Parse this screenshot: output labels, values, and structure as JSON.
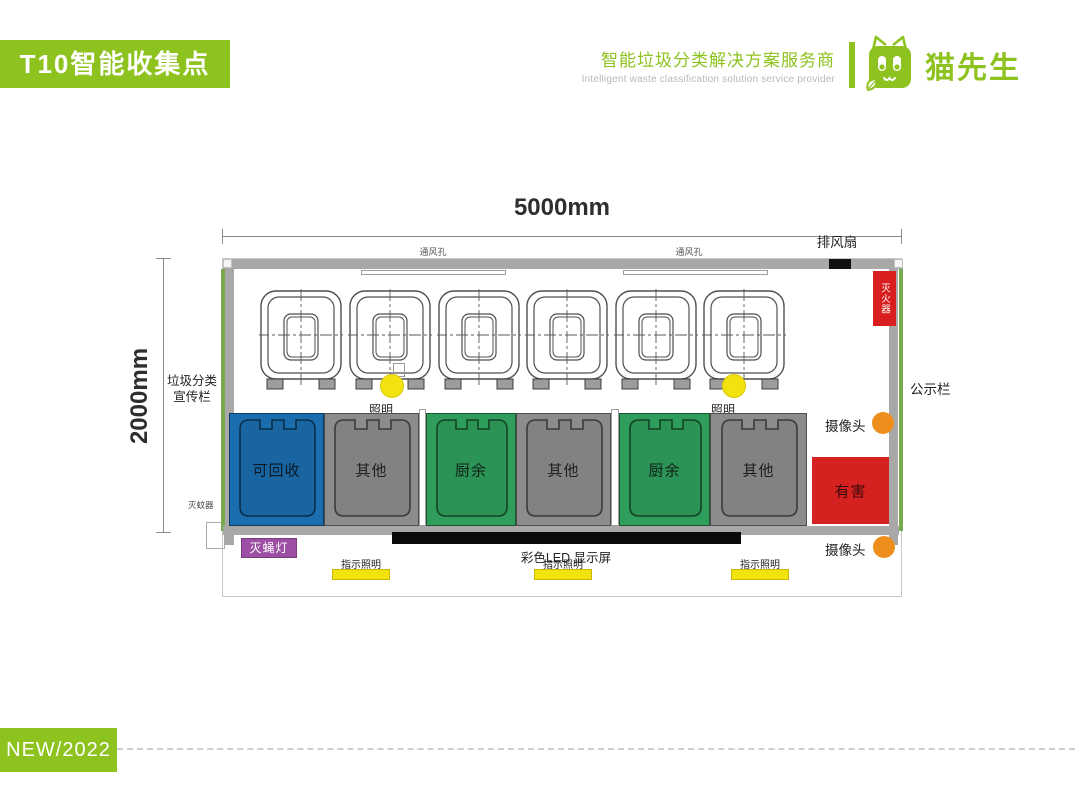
{
  "header": {
    "banner": "T10智能收集点",
    "tagline_cn": "智能垃圾分类解决方案服务商",
    "tagline_en": "Intelligent waste classification solution service provider",
    "brand": "猫先生"
  },
  "footer": {
    "badge": "NEW/2022"
  },
  "colors": {
    "brand_green": "#8dc21f",
    "wall_gray": "#a8a8a8",
    "recyclable_blue": "#1a6dae",
    "other_gray": "#8c8c8c",
    "kitchen_green": "#2f9e5c",
    "hazard_red": "#d62121",
    "highlight_yellow": "#f2e30e",
    "camera_orange": "#ee8f1d",
    "fly_lamp_purple": "#9d4fa3",
    "led_black": "#0a0a0a"
  },
  "diagram": {
    "width_label": "5000mm",
    "height_label": "2000mm",
    "labels": {
      "vent": "通风孔",
      "exhaust_fan": "排风扇",
      "fire_extinguisher": "灭火器",
      "notice_board": "公示栏",
      "camera": "摄像头",
      "publicity_board_line1": "垃圾分类",
      "publicity_board_line2": "宣传栏",
      "lighting": "照明",
      "mosquito_killer": "灭蚊器",
      "fly_lamp": "灭蝇灯",
      "led_screen": "彩色LED 显示屏",
      "indicator_lighting": "指示照明"
    },
    "bins": [
      {
        "label": "可回收",
        "color": "#1a6dae"
      },
      {
        "label": "其他",
        "color": "#8c8c8c"
      },
      {
        "label": "厨余",
        "color": "#2f9e5c"
      },
      {
        "label": "其他",
        "color": "#8c8c8c"
      },
      {
        "label": "厨余",
        "color": "#2f9e5c"
      },
      {
        "label": "其他",
        "color": "#8c8c8c"
      }
    ],
    "hazard_bin": {
      "label": "有害",
      "color": "#d62121"
    }
  }
}
